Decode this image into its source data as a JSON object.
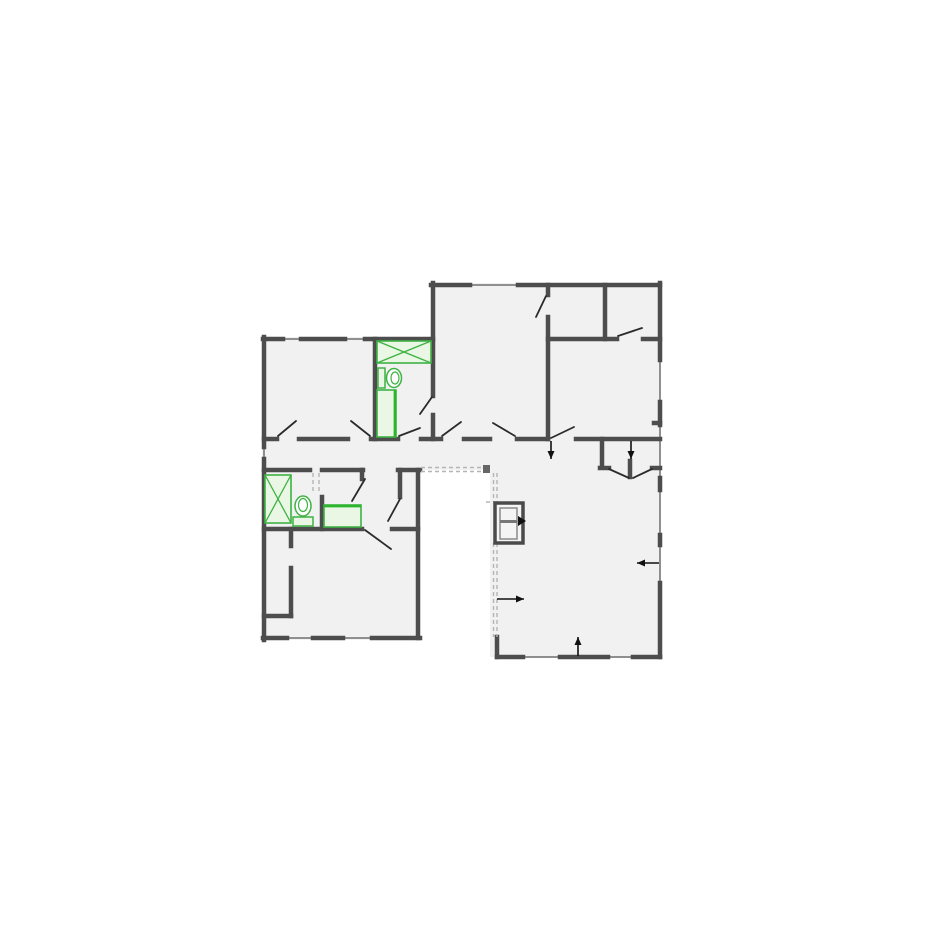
{
  "canvas": {
    "width": 925,
    "height": 925,
    "background": "#ffffff"
  },
  "palette": {
    "wall": "#4d4d4d",
    "window": "#8f8f8f",
    "room_fill": "#f1f1f1",
    "fixture_green": "#3db343",
    "fixture_fill": "#eaf7e4",
    "fixture_accent": "#2db52d",
    "door_leaf": "#2b2b2b",
    "annotation": "#111111",
    "dashed": "#b5b5b5",
    "dashed_cap": "#666666",
    "cabinet_stroke": "#4a4a4a",
    "cabinet_inner": "#8a8a8a",
    "cabinet_fill": "#f4f4f4"
  },
  "floorplan": {
    "fills": [
      {
        "x": 262,
        "y": 337,
        "w": 173,
        "h": 133
      },
      {
        "x": 262,
        "y": 470,
        "w": 158,
        "h": 170
      },
      {
        "x": 431,
        "y": 283,
        "w": 229,
        "h": 156
      },
      {
        "x": 262,
        "y": 437,
        "w": 398,
        "h": 33
      },
      {
        "x": 600,
        "y": 439,
        "w": 60,
        "h": 42
      },
      {
        "x": 490,
        "y": 470,
        "w": 170,
        "h": 187
      }
    ],
    "walls": [
      [
        263,
        339,
        283,
        339
      ],
      [
        301,
        339,
        345,
        339
      ],
      [
        365,
        339,
        433,
        339
      ],
      [
        433,
        283,
        433,
        396
      ],
      [
        433,
        415,
        433,
        439
      ],
      [
        431,
        285,
        470,
        285
      ],
      [
        518,
        285,
        660,
        285
      ],
      [
        548,
        285,
        548,
        295
      ],
      [
        548,
        317,
        548,
        439
      ],
      [
        605,
        285,
        605,
        339
      ],
      [
        548,
        339,
        617,
        339
      ],
      [
        643,
        339,
        660,
        339
      ],
      [
        660,
        283,
        660,
        360
      ],
      [
        660,
        402,
        660,
        425
      ],
      [
        660,
        478,
        660,
        490
      ],
      [
        660,
        535,
        660,
        545
      ],
      [
        660,
        583,
        660,
        657
      ],
      [
        654,
        423,
        660,
        423
      ],
      [
        264,
        337,
        264,
        447
      ],
      [
        264,
        459,
        264,
        640
      ],
      [
        264,
        439,
        277,
        439
      ],
      [
        299,
        439,
        348,
        439
      ],
      [
        371,
        439,
        398,
        439
      ],
      [
        421,
        439,
        441,
        439
      ],
      [
        464,
        439,
        490,
        439
      ],
      [
        517,
        439,
        548,
        439
      ],
      [
        576,
        439,
        660,
        439
      ],
      [
        264,
        470,
        310,
        470
      ],
      [
        322,
        470,
        363,
        470
      ],
      [
        398,
        470,
        420,
        470
      ],
      [
        362,
        470,
        362,
        479
      ],
      [
        322,
        497,
        322,
        529
      ],
      [
        264,
        529,
        362,
        529
      ],
      [
        392,
        529,
        418,
        529
      ],
      [
        400,
        470,
        400,
        497
      ],
      [
        418,
        470,
        418,
        638
      ],
      [
        375,
        339,
        375,
        439
      ],
      [
        291,
        529,
        291,
        546
      ],
      [
        291,
        568,
        291,
        616
      ],
      [
        264,
        616,
        291,
        616
      ],
      [
        263,
        638,
        287,
        638
      ],
      [
        313,
        638,
        343,
        638
      ],
      [
        372,
        638,
        420,
        638
      ],
      [
        602,
        439,
        602,
        467
      ],
      [
        600,
        468,
        609,
        468
      ],
      [
        652,
        468,
        660,
        468
      ],
      [
        630,
        461,
        630,
        477
      ],
      [
        497,
        637,
        497,
        657
      ],
      [
        497,
        657,
        523,
        657
      ],
      [
        560,
        657,
        608,
        657
      ],
      [
        633,
        657,
        660,
        657
      ]
    ],
    "windows": [
      [
        283,
        339,
        301,
        339
      ],
      [
        345,
        339,
        365,
        339
      ],
      [
        470,
        285,
        518,
        285
      ],
      [
        660,
        360,
        660,
        402
      ],
      [
        660,
        425,
        660,
        478
      ],
      [
        660,
        490,
        660,
        535
      ],
      [
        660,
        545,
        660,
        583
      ],
      [
        264,
        447,
        264,
        459
      ],
      [
        287,
        638,
        313,
        638
      ],
      [
        343,
        638,
        372,
        638
      ],
      [
        523,
        657,
        560,
        657
      ],
      [
        608,
        657,
        633,
        657
      ]
    ],
    "door_leaves": [
      [
        278,
        436,
        296,
        421
      ],
      [
        370,
        436,
        351,
        421
      ],
      [
        399,
        436,
        420,
        428
      ],
      [
        442,
        436,
        461,
        422
      ],
      [
        515,
        436,
        493,
        423
      ],
      [
        551,
        438,
        574,
        427
      ],
      [
        546,
        296,
        536,
        317
      ],
      [
        618,
        336,
        642,
        328
      ],
      [
        432,
        397,
        420,
        414
      ],
      [
        352,
        501,
        365,
        479
      ],
      [
        400,
        499,
        388,
        521
      ],
      [
        365,
        530,
        391,
        549
      ],
      [
        609,
        469,
        629,
        478
      ],
      [
        633,
        478,
        652,
        469
      ]
    ],
    "dashed_lines": [
      [
        421,
        467.5,
        483,
        467.5
      ],
      [
        421,
        471.5,
        483,
        471.5
      ],
      [
        493.5,
        473,
        493.5,
        502
      ],
      [
        497,
        473,
        497,
        502
      ],
      [
        493.5,
        543,
        493.5,
        637
      ],
      [
        497,
        543,
        497,
        637
      ],
      [
        313,
        473,
        313,
        494
      ],
      [
        319,
        473,
        319,
        494
      ],
      [
        486,
        502,
        495,
        502
      ]
    ],
    "dashed_caps": [
      {
        "x": 483,
        "y": 465,
        "w": 7,
        "h": 8
      }
    ],
    "arrows": [
      {
        "x1": 551,
        "y1": 441,
        "x2": 551,
        "y2": 459
      },
      {
        "x1": 631,
        "y1": 441,
        "x2": 631,
        "y2": 459
      },
      {
        "x1": 659,
        "y1": 563,
        "x2": 637,
        "y2": 563
      },
      {
        "x1": 497,
        "y1": 599,
        "x2": 524,
        "y2": 599
      },
      {
        "x1": 578,
        "y1": 656,
        "x2": 578,
        "y2": 637
      }
    ],
    "bathtub": {
      "x": 377,
      "y": 341,
      "w": 54,
      "h": 22
    },
    "shower": {
      "x": 265,
      "y": 475,
      "w": 26,
      "h": 48
    },
    "vanities": [
      {
        "x": 377,
        "y": 390,
        "w": 19,
        "h": 47,
        "accent": "right"
      },
      {
        "x": 324,
        "y": 505,
        "w": 37,
        "h": 22,
        "accent": "top"
      }
    ],
    "toilets": [
      {
        "orient": "right",
        "tank": {
          "x": 378,
          "y": 368,
          "w": 7,
          "h": 20
        },
        "bowl": {
          "cx": 394,
          "cy": 378,
          "rx": 7.5,
          "ry": 9.5
        },
        "inner": {
          "cx": 395,
          "cy": 378,
          "rx": 4,
          "ry": 6
        }
      },
      {
        "orient": "up",
        "tank": {
          "x": 293,
          "y": 517,
          "w": 20,
          "h": 9
        },
        "bowl": {
          "cx": 303,
          "cy": 506,
          "rx": 8,
          "ry": 10
        },
        "inner": {
          "cx": 303,
          "cy": 505,
          "rx": 4.5,
          "ry": 6.5
        }
      }
    ],
    "cabinet": {
      "outer": {
        "x": 495,
        "y": 503,
        "w": 28,
        "h": 40
      },
      "inner": {
        "x": 500,
        "y": 508,
        "w": 17,
        "h": 31
      },
      "divider_y": 521.5,
      "knob": [
        [
          518,
          516
        ],
        [
          518,
          526
        ],
        [
          526,
          521
        ]
      ]
    }
  }
}
